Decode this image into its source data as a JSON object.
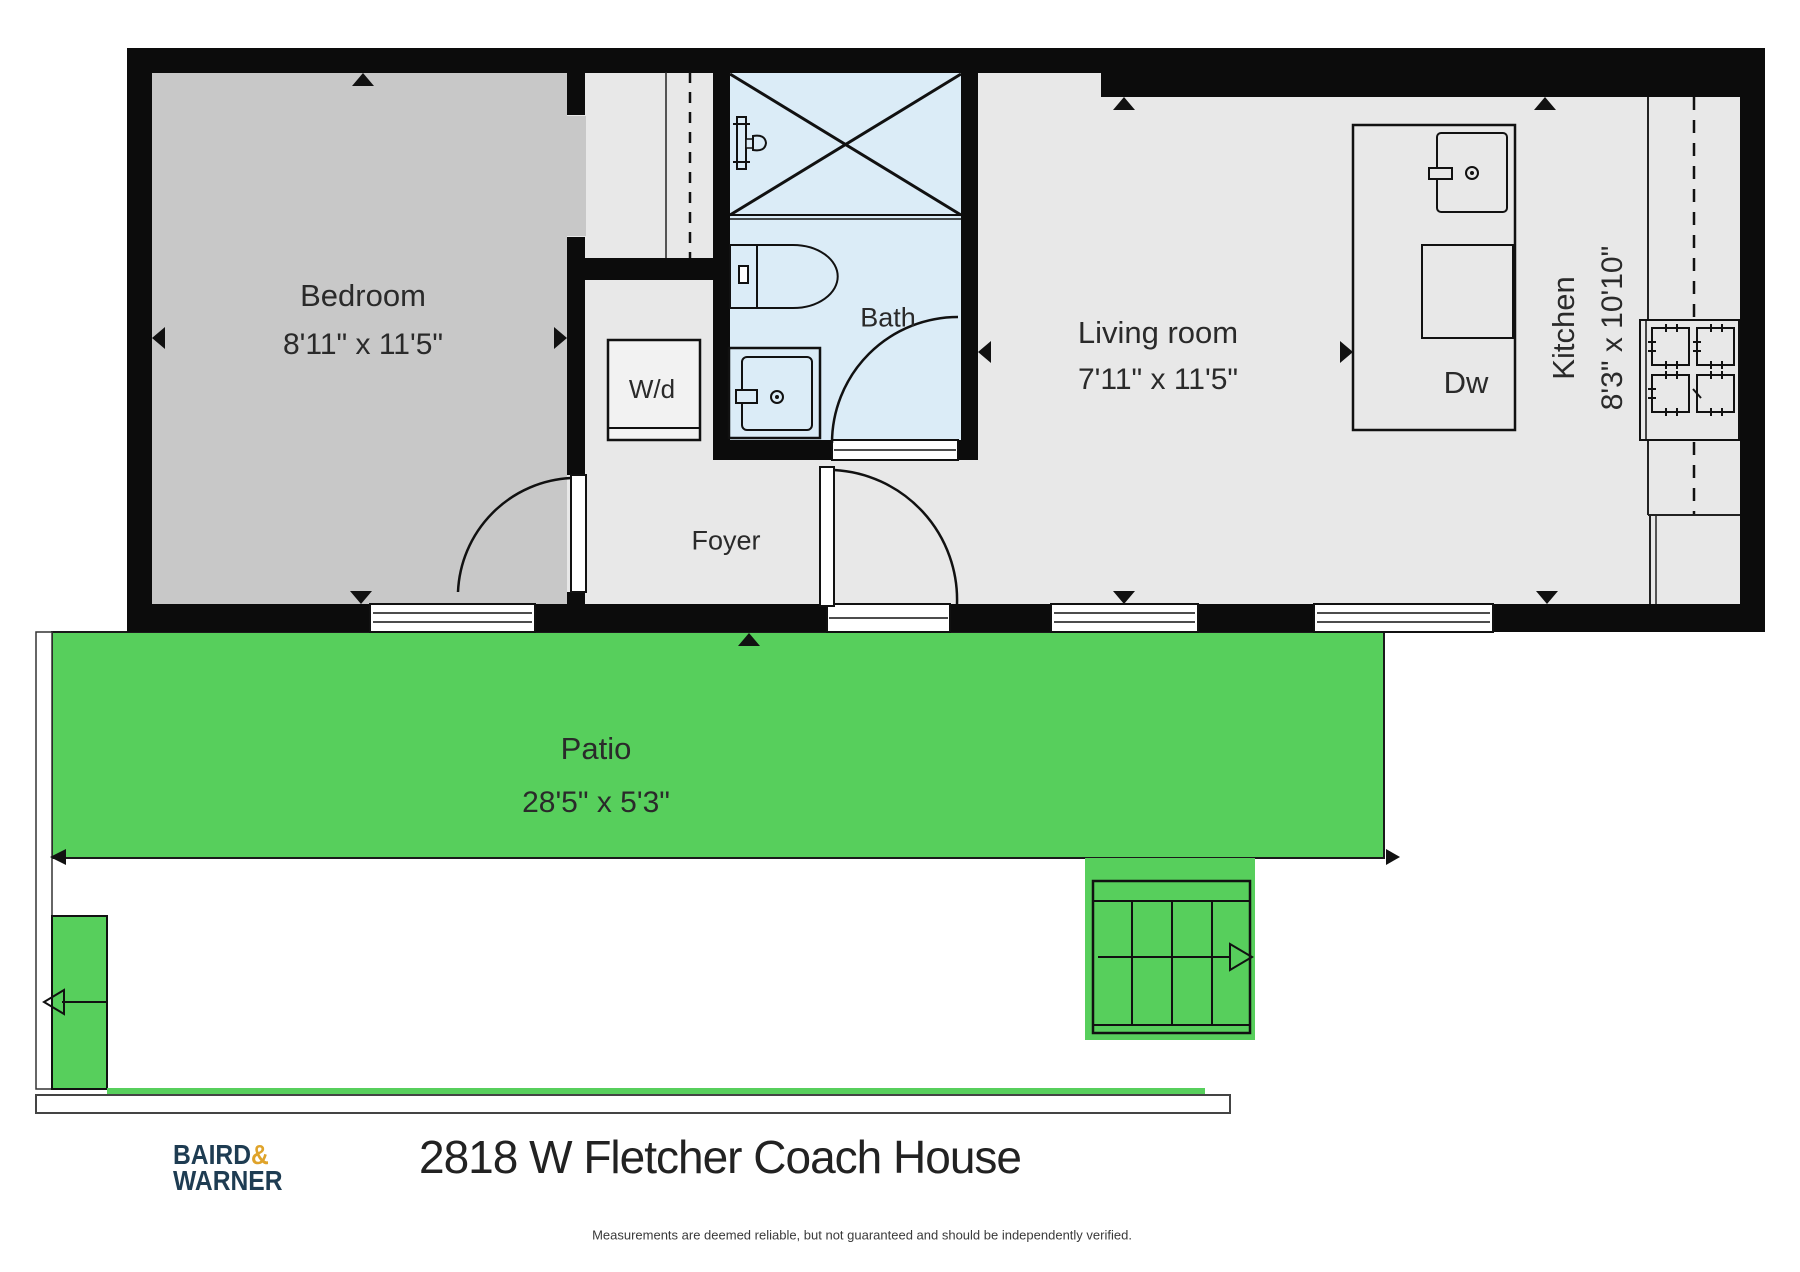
{
  "document": {
    "title": "2818 W Fletcher Coach House",
    "disclaimer": "Measurements are deemed reliable, but not guaranteed and should be independently verified.",
    "brand": {
      "word1": "BAIRD",
      "amp": "&",
      "word2": "WARNER"
    }
  },
  "rooms": {
    "bedroom": {
      "name": "Bedroom",
      "dims": "8'11\" x 11'5\""
    },
    "bath": {
      "name": "Bath"
    },
    "foyer": {
      "name": "Foyer"
    },
    "washer_dryer": {
      "label": "W/d"
    },
    "living": {
      "name": "Living room",
      "dims": "7'11\" x 11'5\""
    },
    "kitchen": {
      "name": "Kitchen",
      "dims": "8'3\" x 10'10\""
    },
    "dishwasher": {
      "label": "Dw"
    },
    "patio": {
      "name": "Patio",
      "dims": "28'5\" x 5'3\""
    }
  },
  "colors": {
    "wall": "#0c0c0c",
    "bedroom_floor": "#c8c8c8",
    "floor": "#e8e8e8",
    "bath_floor": "#dbecf7",
    "patio_green": "#57cf5c",
    "brand_navy": "#1e3c52",
    "brand_gold": "#dfa32a"
  }
}
